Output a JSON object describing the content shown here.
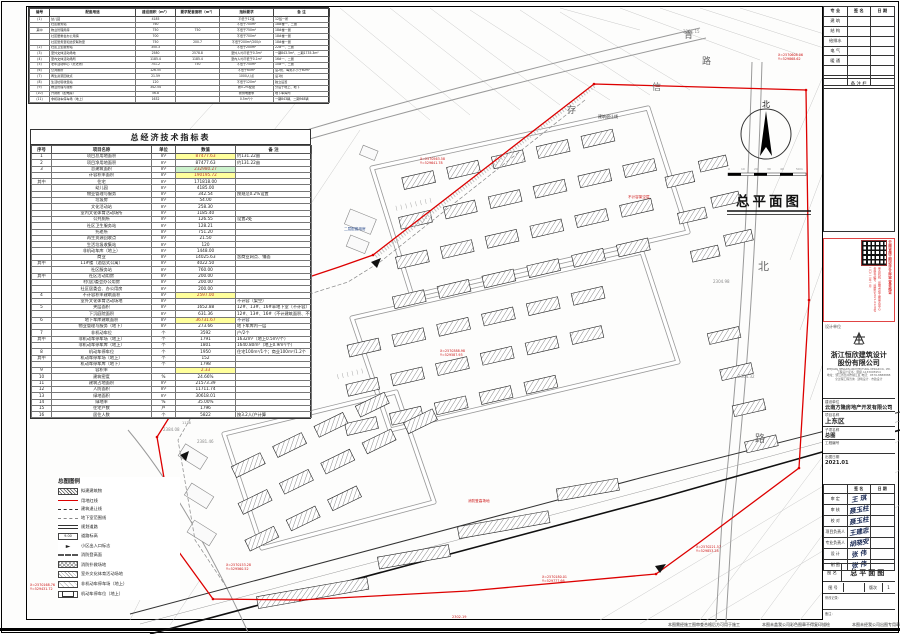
{
  "sheet_title": "总平面图",
  "facilities": {
    "headers": [
      "编号",
      "配套用途",
      "建设面积（m²）",
      "要求配套面积（m²）",
      "指标要求",
      "备 注"
    ],
    "rows": [
      [
        "(1)",
        "幼儿园",
        "4185",
        "",
        "不低于12班",
        "12班一所"
      ],
      [
        "",
        "社区服务站",
        "760",
        "",
        "不低于700m²",
        "18#楼一、二层"
      ],
      [
        "其中",
        "物业管理用房",
        "750",
        "750",
        "不低于750m²",
        "18#楼一层"
      ],
      [
        "",
        "社区居委会办公用房",
        "700",
        "",
        "不低于700m²",
        "18#楼一层"
      ],
      [
        "",
        "社区警务室和治安联防室",
        "750",
        "200.7",
        "不低于200m²/200户",
        "18#楼一层"
      ],
      [
        "(2)",
        "社区卫生服务站",
        "350.3",
        "",
        "不低于200m²",
        "22#一、二层"
      ],
      [
        "(3)",
        "室外文体活动场地",
        "2580",
        "2578.8",
        "室外人均不低于0.3m²",
        "一期843.5m²、二期1735.3m²"
      ],
      [
        "(4)",
        "室内文体活动场所",
        "1185.4",
        "1185.4",
        "室内人均不低于0.1m²",
        "16#一、二层"
      ],
      [
        "(5)",
        "老年活动中心（托老所）",
        "751.2",
        "750",
        "不低于750m²",
        "10#一、二层"
      ],
      [
        "(6)",
        "公共厕所",
        "126.55",
        "",
        "不低于60m²",
        "设2处，每处不小于60m²"
      ],
      [
        "(7)",
        "再生资源回收点",
        "21.59",
        "",
        "1000人/点",
        "设1处"
      ],
      [
        "(8)",
        "生活垃圾收集站",
        "120",
        "",
        "不低于120m²",
        "独立设置"
      ],
      [
        "(9)",
        "物业管理与服务",
        "342.54",
        "",
        "按0.2%配建",
        "分设于地上、地下"
      ],
      [
        "(10)",
        "开闭所（配电房）",
        "56.8",
        "",
        "按供电要求",
        "地下车库内"
      ],
      [
        "(11)",
        "非机动车停车场（地上）",
        "1632",
        "",
        "0.5m²/个",
        "一期843辆、二期948辆"
      ]
    ]
  },
  "econ": {
    "title": "总经济技术指标表",
    "headers": [
      "序号",
      "项目名称",
      "单位",
      "数值",
      "备 注"
    ],
    "rows": [
      {
        "n": "1",
        "name": "项目总用地面积",
        "u": "m²",
        "v": "87477.63",
        "note": "约131.22亩",
        "hl": "y"
      },
      {
        "n": "2",
        "name": "项目净用地面积",
        "u": "m²",
        "v": "87477.63",
        "note": "约131.22亩",
        "hl": ""
      },
      {
        "n": "3",
        "name": "总建筑面积",
        "u": "m²",
        "v": "232980.27",
        "note": "",
        "hl": "g"
      },
      {
        "n": "",
        "name": "计容积率面积",
        "u": "m²",
        "v": "190195.72",
        "note": "",
        "hl": "y"
      },
      {
        "n": "其中",
        "name": "住宅",
        "u": "m²",
        "v": "171818.00",
        "note": "",
        "hl": ""
      },
      {
        "n": "",
        "name": "幼儿园",
        "u": "m²",
        "v": "4185.00",
        "note": "",
        "hl": ""
      },
      {
        "n": "",
        "name": "物业管理与服务",
        "u": "m²",
        "v": "342.54",
        "note": "按规范0.2%设置",
        "hl": ""
      },
      {
        "n": "",
        "name": "垃圾房",
        "u": "m²",
        "v": "54.00",
        "note": "",
        "hl": ""
      },
      {
        "n": "",
        "name": "文化活动站",
        "u": "m²",
        "v": "258.30",
        "note": "",
        "hl": ""
      },
      {
        "n": "",
        "name": "室内文化体育活动场所",
        "u": "m²",
        "v": "1185.40",
        "note": "",
        "hl": ""
      },
      {
        "n": "",
        "name": "公共厕所",
        "u": "m²",
        "v": "126.55",
        "note": "设置2处",
        "hl": ""
      },
      {
        "n": "",
        "name": "社区卫生服务站",
        "u": "m²",
        "v": "128.21",
        "note": "",
        "hl": ""
      },
      {
        "n": "",
        "name": "托老所",
        "u": "m²",
        "v": "751.20",
        "note": "",
        "hl": ""
      },
      {
        "n": "",
        "name": "再生资源回收点",
        "u": "m²",
        "v": "21.50",
        "note": "",
        "hl": ""
      },
      {
        "n": "",
        "name": "生活垃圾收集站",
        "u": "m²",
        "v": "120",
        "note": "",
        "hl": ""
      },
      {
        "n": "",
        "name": "非机动车库（地上）",
        "u": "m²",
        "v": "1448.00",
        "note": "",
        "hl": ""
      },
      {
        "n": "",
        "name": "商业",
        "u": "m²",
        "v": "14025.63",
        "note": "含商业网点、铺面",
        "hl": ""
      },
      {
        "n": "其中",
        "name": "11#楼（酒店式公寓）",
        "u": "m²",
        "v": "4022.50",
        "note": "",
        "hl": ""
      },
      {
        "n": "",
        "name": "社区服务站",
        "u": "m²",
        "v": "760.00",
        "note": "",
        "hl": ""
      },
      {
        "n": "其中",
        "name": "社区活动用房",
        "u": "m²",
        "v": "200.00",
        "note": "",
        "hl": ""
      },
      {
        "n": "",
        "name": "村(居)委会办公用房",
        "u": "m²",
        "v": "200.00",
        "note": "",
        "hl": ""
      },
      {
        "n": "",
        "name": "社区居委会、办公用房",
        "u": "m²",
        "v": "200.00",
        "note": "",
        "hl": ""
      },
      {
        "n": "4",
        "name": "不计容积率建筑面积",
        "u": "m²",
        "v": "2597.00",
        "note": "",
        "hl": "y"
      },
      {
        "n": "",
        "name": "室外文化体育活动场地",
        "u": "m²",
        "v": "",
        "note": "不计容（架空）",
        "hl": ""
      },
      {
        "n": "5",
        "name": "夹层面积",
        "u": "m²",
        "v": "1652.88",
        "note": "12#、13#、16#半地下室（不计容）",
        "hl": ""
      },
      {
        "n": "",
        "name": "下沉庭院面积",
        "u": "m²",
        "v": "631.36",
        "note": "12#、13#、16#（不计建筑面积、不计容积率）",
        "hl": ""
      },
      {
        "n": "6",
        "name": "地下车库建筑面积",
        "u": "m²",
        "v": "36731.67",
        "note": "不计容",
        "hl": "y"
      },
      {
        "n": "",
        "name": "物业管理与服务（地下）",
        "u": "m²",
        "v": "273.66",
        "note": "地下车库内一层",
        "hl": ""
      },
      {
        "n": "7",
        "name": "非机动车位",
        "u": "个",
        "v": "3592",
        "note": "户/2个",
        "hl": ""
      },
      {
        "n": "其中",
        "name": "非机动车停车场（地上）",
        "u": "个",
        "v": "1791",
        "note": "1632m²（地上0.5m²/个）",
        "hl": ""
      },
      {
        "n": "",
        "name": "非机动车停车库（地上）",
        "u": "个",
        "v": "1801",
        "note": "1640.80m²（地上0.9m²/个）",
        "hl": ""
      },
      {
        "n": "8",
        "name": "机动车停车位",
        "u": "个",
        "v": "1950",
        "note": "住宅100m²/1个；商业100m²/1.2个",
        "hl": ""
      },
      {
        "n": "其中",
        "name": "机动车停车场（地上）",
        "u": "个",
        "v": "152",
        "note": "",
        "hl": ""
      },
      {
        "n": "",
        "name": "机动车停车库（地下）",
        "u": "个",
        "v": "1798",
        "note": "",
        "hl": ""
      },
      {
        "n": "9",
        "name": "容积率",
        "u": "",
        "v": "2.33",
        "note": "",
        "hl": "y"
      },
      {
        "n": "10",
        "name": "建筑密度",
        "u": "%",
        "v": "24.66%",
        "note": "",
        "hl": ""
      },
      {
        "n": "11",
        "name": "建筑占地面积",
        "u": "m²",
        "v": "21573.39",
        "note": "",
        "hl": ""
      },
      {
        "n": "12",
        "name": "人防面积",
        "u": "m²",
        "v": "11711.74",
        "note": "",
        "hl": ""
      },
      {
        "n": "13",
        "name": "绿地面积",
        "u": "m²",
        "v": "30618.01",
        "note": "",
        "hl": ""
      },
      {
        "n": "14",
        "name": "绿地率",
        "u": "%",
        "v": "35.00%",
        "note": "",
        "hl": ""
      },
      {
        "n": "15",
        "name": "住宅户数",
        "u": "户",
        "v": "1796",
        "note": "",
        "hl": ""
      },
      {
        "n": "16",
        "name": "居住人数",
        "u": "个",
        "v": "5822",
        "note": "按3.2人/户计算",
        "hl": ""
      }
    ]
  },
  "legend": {
    "title": "总图图例",
    "items": [
      {
        "sw": "hatch",
        "label": "拟建建筑物"
      },
      {
        "sw": "redline",
        "label": "用地红线"
      },
      {
        "sw": "dashdot",
        "label": "建筑退让线"
      },
      {
        "sw": "dash",
        "label": "地下室范围线"
      },
      {
        "sw": "dbl",
        "label": "规划道路"
      },
      {
        "sw": "elev",
        "label": "道路标高",
        "extra": "9.00"
      },
      {
        "sw": "arrow",
        "label": "小区出入口标志",
        "extra": "►"
      },
      {
        "sw": "dashw",
        "label": "消防登高面"
      },
      {
        "sw": "cross",
        "label": "消防扑救场地"
      },
      {
        "sw": "diag",
        "label": "室外文化体育活动场地"
      },
      {
        "sw": "light",
        "label": "非机动车停车场（地上）"
      },
      {
        "sw": "rect",
        "label": "机动车停车位（地上）"
      }
    ]
  },
  "kuaiqian": {
    "headers": [
      "专 业",
      "签 名",
      "日 期"
    ],
    "rows": [
      "建 筑",
      "结 构",
      "给排水",
      "电 气",
      "暖 通",
      "",
      ""
    ],
    "note_strip": "备 注 栏"
  },
  "stamp": {
    "main": "云南省施工图设计文件审查合格证",
    "lines": [
      "审查机构：昆明市施工图审查中心",
      "合格书编号：昆审字2021-0128号",
      "二〇二一年一月"
    ]
  },
  "titleblock": {
    "designer_label": "设计单位",
    "company_cn1": "浙江恒欣建筑设计",
    "company_cn2": "股份有限公司",
    "company_en": "ZHEJIANG HENGXIN ARCHITECTURAL DESIGN CO., LTD.",
    "cert1": "工程设计证书：甲级 A133005954",
    "cert2": "地址：浙江省台州市椒江区 电话：0576-8888888",
    "cert3": "全过程工程咨询 · 建筑设计 · 市政设计",
    "fields": [
      {
        "label": "建设单位",
        "value": "云南方隆房地产开发有限公司",
        "big": false
      },
      {
        "label": "项目名称",
        "value": "上东区",
        "big": true
      },
      {
        "label": "子项名称",
        "value": "总图",
        "big": false
      },
      {
        "label": "工程编号",
        "value": "",
        "big": false
      },
      {
        "label": "出图日期",
        "value": "2021.01",
        "big": false
      }
    ],
    "sign_headers": [
      "",
      "签 名",
      "日 期"
    ],
    "signs": [
      {
        "label": "审 定",
        "name": "王 琪"
      },
      {
        "label": "审 核",
        "name": "聂玉柱"
      },
      {
        "label": "校 对",
        "name": "聂玉柱"
      },
      {
        "label": "项目负责人",
        "name": "王建忠"
      },
      {
        "label": "专业负责人",
        "name": "胡晓安"
      },
      {
        "label": "设 计",
        "name": "张 伟"
      },
      {
        "label": "制 图",
        "name": "张 伟"
      }
    ],
    "dwgname_label": "图 名",
    "dwgname": "总平面图",
    "dwgno_label": "图 号",
    "dwgno": "",
    "rev_label": "版次",
    "rev": "1",
    "note1": "修改记录：",
    "note2": "备注："
  },
  "bottom_notes": [
    {
      "x": 668,
      "text": "本图需经施工图审查合格后方可用于施工"
    },
    {
      "x": 762,
      "text": "本图未盖我公司彩色图章不得复印描绘"
    },
    {
      "x": 852,
      "text": "本图未经我公司出图专用章无效"
    }
  ],
  "plan": {
    "title": "总平面图",
    "north_label": "北",
    "texts": [
      {
        "x": 684,
        "y": 38,
        "t": "青",
        "c": "t-road",
        "fs": 9
      },
      {
        "x": 702,
        "y": 64,
        "t": "路",
        "c": "t-road",
        "fs": 9
      },
      {
        "x": 652,
        "y": 90,
        "t": "信",
        "c": "t-road",
        "fs": 9
      },
      {
        "x": 567,
        "y": 113,
        "t": "存",
        "c": "t-road",
        "fs": 9
      },
      {
        "x": 758,
        "y": 270,
        "t": "北",
        "c": "t-road",
        "fs": 11
      },
      {
        "x": 755,
        "y": 442,
        "t": "路",
        "c": "t-road",
        "fs": 10
      },
      {
        "x": 163,
        "y": 431,
        "t": "2384.08",
        "c": "t-gray",
        "fs": 4
      },
      {
        "x": 182,
        "y": 424,
        "t": "1136",
        "c": "t-gray",
        "fs": 3.5
      },
      {
        "x": 197,
        "y": 443,
        "t": "2381.46",
        "c": "t-gray",
        "fs": 4
      },
      {
        "x": 683,
        "y": 33,
        "t": "2381.15",
        "c": "t-gray",
        "fs": 4
      },
      {
        "x": 157,
        "y": 369,
        "t": "2302.75",
        "c": "t-gray",
        "fs": 4
      },
      {
        "x": 738,
        "y": 378,
        "t": "2304.32",
        "c": "t-gray",
        "fs": 4
      },
      {
        "x": 713,
        "y": 283,
        "t": "2304.98",
        "c": "t-gray",
        "fs": 4
      },
      {
        "x": 162,
        "y": 566,
        "t": "2302.19",
        "c": "t-gray",
        "fs": 4
      },
      {
        "x": 452,
        "y": 618,
        "t": "2302.19",
        "c": "t-red",
        "fs": 3.5
      },
      {
        "x": 420,
        "y": 160,
        "t": "X=2570563.58",
        "c": "t-red",
        "fs": 3.3
      },
      {
        "x": 420,
        "y": 164,
        "t": "Y=529641.78",
        "c": "t-red",
        "fs": 3.3
      },
      {
        "x": 250,
        "y": 216,
        "t": "X=2570462.04",
        "c": "t-red",
        "fs": 3.3
      },
      {
        "x": 250,
        "y": 220,
        "t": "Y=529562.03",
        "c": "t-red",
        "fs": 3.3
      },
      {
        "x": 96,
        "y": 331,
        "t": "X=2570329.17",
        "c": "t-red",
        "fs": 3.3
      },
      {
        "x": 96,
        "y": 335,
        "t": "Y=529417.04",
        "c": "t-red",
        "fs": 3.3
      },
      {
        "x": 48,
        "y": 381,
        "t": "X=2570291.96",
        "c": "t-red",
        "fs": 3.3
      },
      {
        "x": 48,
        "y": 385,
        "t": "Y=529402.98",
        "c": "t-red",
        "fs": 3.3
      },
      {
        "x": 84,
        "y": 546,
        "t": "X=2570180.53",
        "c": "t-red",
        "fs": 3.3
      },
      {
        "x": 84,
        "y": 550,
        "t": "Y=529411.54",
        "c": "t-red",
        "fs": 3.3
      },
      {
        "x": 30,
        "y": 586,
        "t": "X=2570168.76",
        "c": "t-red",
        "fs": 3.3
      },
      {
        "x": 30,
        "y": 590,
        "t": "Y=529431.72",
        "c": "t-red",
        "fs": 3.3
      },
      {
        "x": 226,
        "y": 566,
        "t": "X=2570153.28",
        "c": "t-red",
        "fs": 3.3
      },
      {
        "x": 226,
        "y": 570,
        "t": "Y=529560.52",
        "c": "t-red",
        "fs": 3.3
      },
      {
        "x": 542,
        "y": 578,
        "t": "X=2570180.01",
        "c": "t-red",
        "fs": 3.3
      },
      {
        "x": 542,
        "y": 582,
        "t": "Y=529777.66",
        "c": "t-red",
        "fs": 3.3
      },
      {
        "x": 696,
        "y": 548,
        "t": "X=2570221.57",
        "c": "t-red",
        "fs": 3.3
      },
      {
        "x": 696,
        "y": 552,
        "t": "Y=529853.28",
        "c": "t-red",
        "fs": 3.3
      },
      {
        "x": 778,
        "y": 56,
        "t": "X=2570608.06",
        "c": "t-red",
        "fs": 3.3
      },
      {
        "x": 778,
        "y": 60,
        "t": "Y=529868.62",
        "c": "t-red",
        "fs": 3.3
      },
      {
        "x": 440,
        "y": 352,
        "t": "X=2570388.98",
        "c": "t-red",
        "fs": 3.3
      },
      {
        "x": 440,
        "y": 356,
        "t": "Y=529587.93",
        "c": "t-red",
        "fs": 3.3
      },
      {
        "x": 188,
        "y": 300,
        "t": "X=2570356.71",
        "c": "t-red",
        "fs": 3.3
      },
      {
        "x": 188,
        "y": 304,
        "t": "Y=529489.90",
        "c": "t-red",
        "fs": 3.3
      },
      {
        "x": 598,
        "y": 118,
        "t": "建筑退让线",
        "c": "t-blk",
        "fs": 4
      },
      {
        "x": 108,
        "y": 517,
        "t": "建筑退让线",
        "c": "t-blk",
        "fs": 4
      },
      {
        "x": 122,
        "y": 343,
        "t": "地下室范围线",
        "c": "t-red",
        "fs": 3.6
      },
      {
        "x": 628,
        "y": 198,
        "t": "不计容架空层",
        "c": "t-red",
        "fs": 3.6
      },
      {
        "x": 344,
        "y": 230,
        "t": "二层配套用房",
        "c": "t-blue",
        "fs": 3.6
      },
      {
        "x": 468,
        "y": 502,
        "t": "消防登高场地",
        "c": "t-red",
        "fs": 3.6
      },
      {
        "x": 728,
        "y": 170,
        "t": "0",
        "c": "t-gray",
        "fs": 3
      },
      {
        "x": 741,
        "y": 170,
        "t": "10",
        "c": "t-gray",
        "fs": 3
      },
      {
        "x": 754,
        "y": 170,
        "t": "20",
        "c": "t-gray",
        "fs": 3
      },
      {
        "x": 767,
        "y": 170,
        "t": "30",
        "c": "t-gray",
        "fs": 3
      },
      {
        "x": 780,
        "y": 170,
        "t": "40",
        "c": "t-gray",
        "fs": 3
      },
      {
        "x": 796,
        "y": 170,
        "t": "50m",
        "c": "t-gray",
        "fs": 3
      }
    ]
  }
}
